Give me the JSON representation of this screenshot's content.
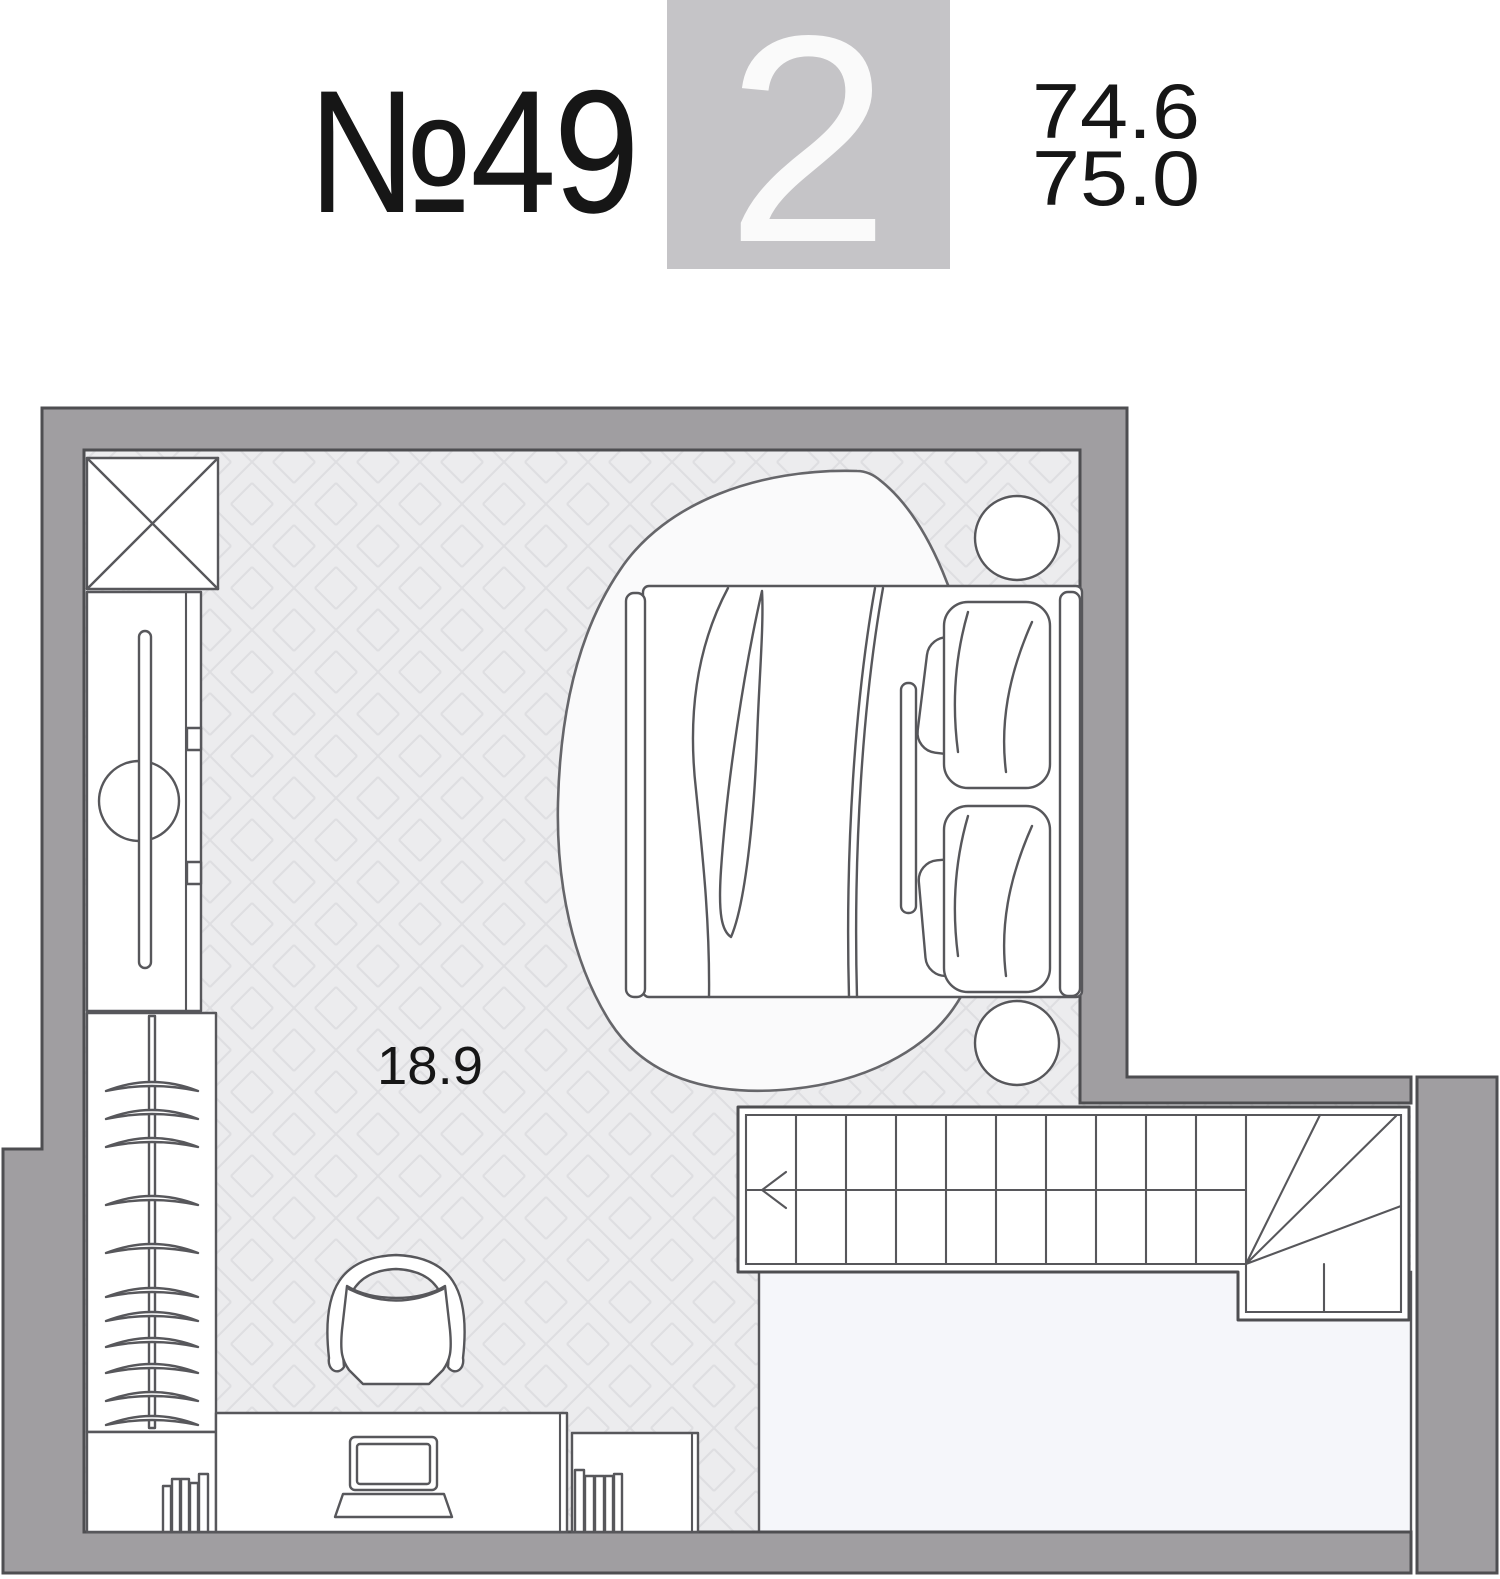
{
  "header": {
    "unit_number": "№49",
    "rooms_count": "2",
    "area_value_1": "74.6",
    "area_value_2": "75.0"
  },
  "plan": {
    "room_area_label": "18.9"
  },
  "icons": {
    "shaft": "crossed-box-shaft-icon",
    "stairs_direction": "arrow-left-icon"
  },
  "colors": {
    "wall_fill": "#a09ea1",
    "outline": "#4e4e51",
    "furniture_stroke": "#57575b",
    "floor_base": "#ececee",
    "floor_line": "#dedee1",
    "void_fill": "#f5f6fa",
    "rug_fill": "#fafafb",
    "badge_bg": "#c5c4c7",
    "badge_text": "#fafafa",
    "text_color": "#161616",
    "background": "#ffffff"
  }
}
